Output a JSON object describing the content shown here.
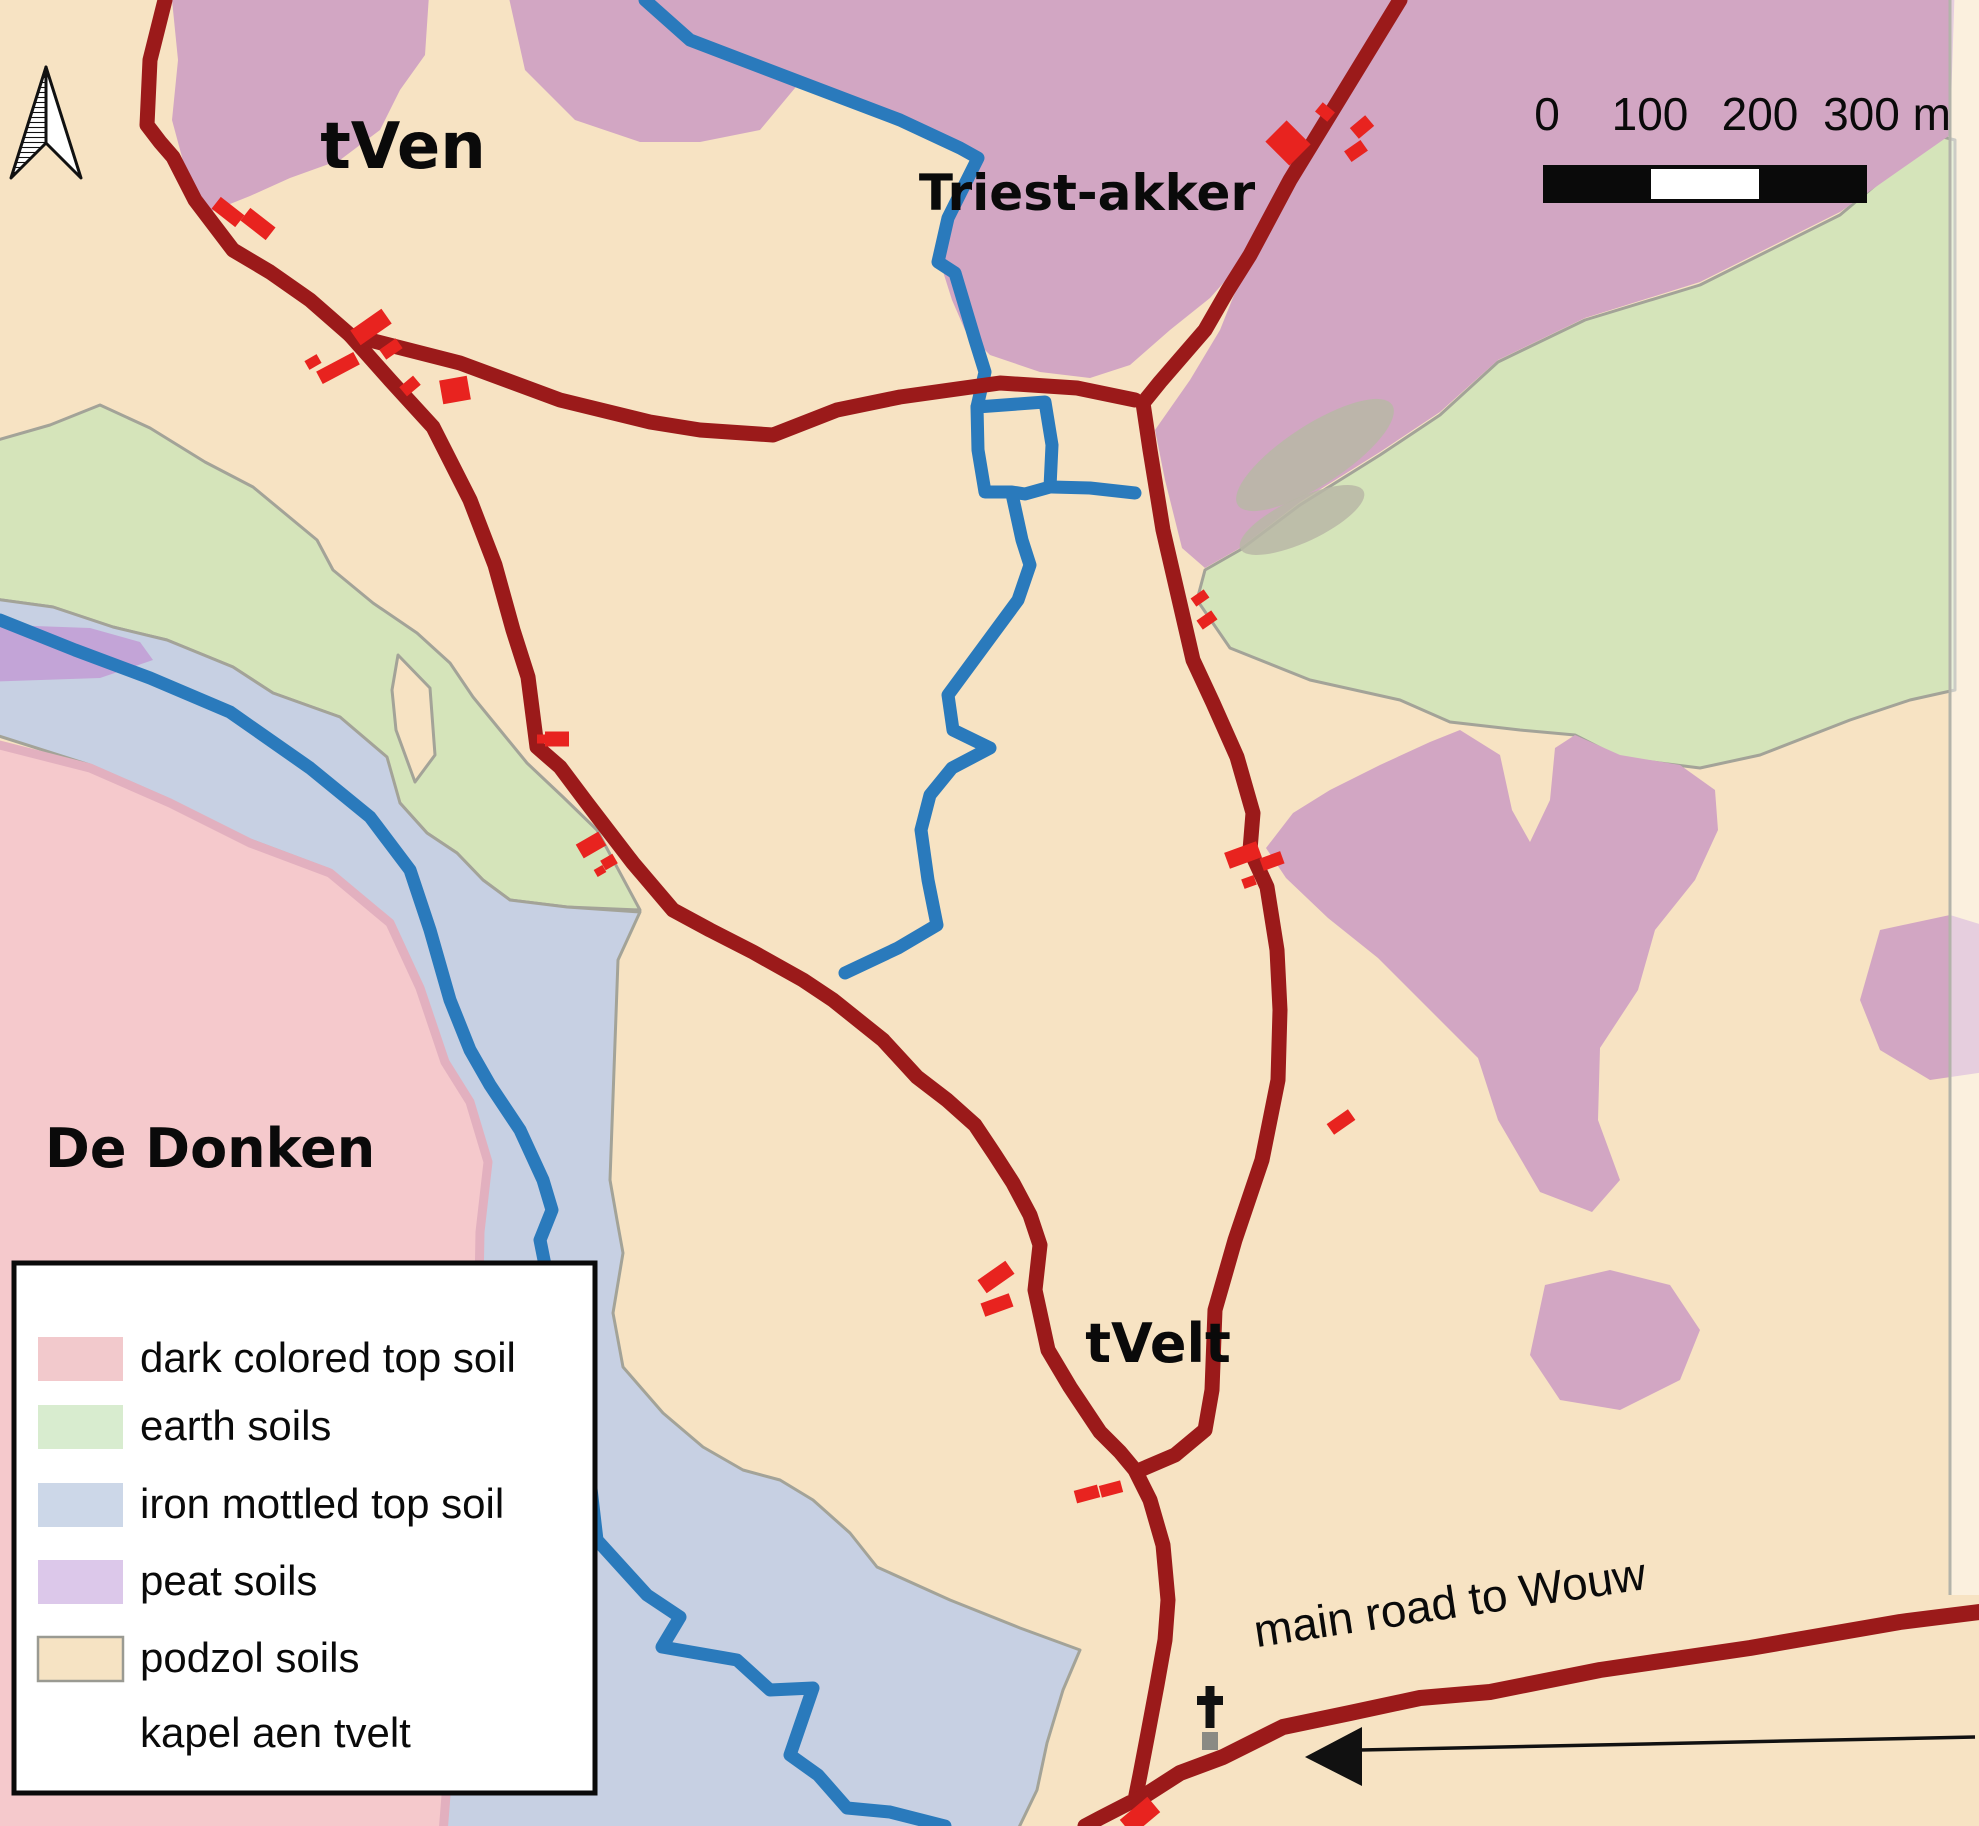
{
  "labels": {
    "tven": "tVen",
    "triest_akker": "Triest-akker",
    "de_donken": "De Donken",
    "tvelt": "tVelt",
    "main_road": "main road to Wouw"
  },
  "scalebar": {
    "ticks": [
      "0",
      "100",
      "200",
      "300 m"
    ]
  },
  "legend": {
    "items": [
      {
        "label": "dark colored top soil",
        "color": "#f2c9cc",
        "stroke": "none"
      },
      {
        "label": "earth soils",
        "color": "#d8eccf",
        "stroke": "none"
      },
      {
        "label": "iron mottled top soil",
        "color": "#ccd7e8",
        "stroke": "none"
      },
      {
        "label": "peat soils",
        "color": "#dcc8ea",
        "stroke": "none"
      },
      {
        "label": "podzol soils",
        "color": "#f6e3c3",
        "stroke": "#9a9a92"
      },
      {
        "label": "kapel aen tvelt"
      }
    ]
  },
  "colors": {
    "podzol": "#f7e3c3",
    "peat": "#d2a6c3",
    "lavender": "#c3a4d7",
    "earth": "#d5e4ba",
    "iron": "#c7d0e3",
    "darksoil": "#f5c9cc",
    "darksoil_border": "#e2b0bf",
    "gray": "#a3a398",
    "road": "#9b1a1a",
    "stream": "#2a7abc",
    "building": "#e8231f",
    "leaf": "#b9b7a6",
    "symbol_black": "#111111",
    "symbol_gray": "#8a8a84"
  },
  "map": {
    "regions": [
      {
        "name": "earth-soil-left",
        "fill": "earth",
        "stroke": "gray",
        "sw": 3,
        "pts": "-20,445 50,425 100,405 150,428 205,462 253,487 317,540 333,570 373,603 417,633 450,663 473,697 500,730 527,763 563,797 597,830 640,910 567,907 510,900 483,880 457,853 427,833 400,803 380,777 340,717 273,693 233,667 167,640 113,627 53,607 -20,597"
      },
      {
        "name": "iron-mottled-main",
        "fill": "iron",
        "stroke": "gray",
        "sw": 3,
        "pts": "-20,597 53,607 113,627 167,640 233,667 273,693 340,717 387,757 400,803 427,833 457,853 483,880 510,900 567,907 640,912 618,960 610,1180 617,1220 623,1253 613,1313 623,1367 663,1413 703,1447 743,1470 780,1480 813,1500 850,1533 877,1567 950,1600 1020,1628 1080,1650 1063,1690 1047,1743 1037,1790 1010,1846 445,1846 448,1750 460,1700 470,1600 477,1400 477,1250 488,1160 470,1100 445,1060 420,985 390,920 330,870 250,840 170,800 90,765 -20,730"
      },
      {
        "name": "dark-topsoil-dedonken",
        "fill": "darksoil",
        "stroke": "darksoil_border",
        "sw": 9,
        "pts": "-20,740 90,768 170,803 250,843 330,873 390,923 420,988 445,1062 470,1102 488,1162 480,1232 477,1400 460,1700 448,1770 442,1846 -20,1846"
      },
      {
        "name": "podzol-wedge",
        "fill": "podzol",
        "stroke": "gray",
        "sw": 3,
        "pts": "398,655 430,688 435,755 415,782 396,730 392,690"
      },
      {
        "name": "earth-soil-right",
        "fill": "earth",
        "stroke": "gray",
        "sw": 3,
        "pts": "1935,135 1840,215 1700,285 1585,320 1498,362 1440,415 1380,455 1300,505 1240,550 1205,570 1197,600 1230,648 1310,680 1400,700 1450,722 1520,730 1575,735 1620,758 1700,768 1760,755 1850,720 1910,700 1955,690 1955,140"
      },
      {
        "name": "peat-tven",
        "fill": "peat",
        "pts": "170,-20 430,-20 425,55 400,90 380,130 340,160 290,178 250,196 210,212 186,172 172,120 178,60"
      },
      {
        "name": "peat-triest-west",
        "fill": "peat",
        "pts": "505,-20 1402,-20 1345,90 1290,180 1242,262 1210,298 1170,330 1130,365 1090,378 1040,372 990,355 965,330 952,300 940,262 948,218 978,158 960,148 900,120 800,82 760,130 700,142 640,142 575,120 525,70"
      },
      {
        "name": "peat-triest-east",
        "fill": "peat",
        "pts": "1412,-20 1955,-20 1950,135 1840,212 1700,282 1585,318 1498,360 1440,412 1380,452 1300,502 1240,548 1205,568 1182,548 1165,480 1155,430 1190,380 1220,330 1242,275 1290,185 1345,92"
      },
      {
        "name": "peat-center-east",
        "fill": "peat",
        "pts": "1293,813 1330,790 1380,765 1430,742 1460,730 1500,755 1512,810 1530,842 1550,800 1555,748 1575,735 1620,755 1680,765 1715,790 1718,830 1695,880 1655,930 1638,990 1600,1048 1598,1120 1620,1180 1592,1212 1540,1192 1498,1120 1478,1058 1428,1008 1378,958 1328,918 1286,878 1266,848"
      },
      {
        "name": "peat-right-edge",
        "fill": "peat",
        "pts": "1880,930 1950,915 1999,930 1999,1070 1930,1080 1880,1050 1860,1000"
      },
      {
        "name": "peat-bottom-right",
        "fill": "peat",
        "pts": "1545,1285 1610,1270 1670,1285 1700,1330 1680,1380 1620,1410 1560,1400 1530,1355"
      },
      {
        "name": "peat-left-lavender",
        "fill": "lavender",
        "pts": "-20,624 90,628 140,642 153,660 100,678 -20,682"
      }
    ],
    "ellipses": [
      {
        "name": "gray-scrub-patch",
        "cx": 1315,
        "cy": 455,
        "rx": 92,
        "ry": 30,
        "rot": -33,
        "fill": "leaf",
        "op": 0.85
      },
      {
        "name": "gray-scrub-patch",
        "cx": 1302,
        "cy": 520,
        "rx": 68,
        "ry": 22,
        "rot": -25,
        "fill": "leaf",
        "op": 0.85
      }
    ],
    "streams": [
      {
        "pts": "645,0 690,40 800,82 900,120 960,148 978,158 948,218 938,262 955,273 975,340 985,372 977,407"
      },
      {
        "pts": "977,407 1045,402 1052,445 1050,487 1025,494 1012,492 985,492 978,450",
        "closed": true
      },
      {
        "pts": "1012,494 1022,540 1030,565 1018,600 948,695 953,730 990,748 952,768 930,795 921,830 928,880 937,925 898,948 845,973"
      },
      {
        "pts": "1052,487 1090,488 1135,493"
      },
      {
        "pts": "0,620 75,650 150,678 230,712 310,768 370,817 410,870 430,930 450,1000 470,1050 490,1085 520,1130 543,1180 552,1210 540,1240 548,1280 560,1350 575,1420 590,1480 597,1540 647,1595 680,1617 662,1647 737,1660 770,1690 813,1688 790,1755 818,1775 847,1808 890,1812 945,1826"
      }
    ],
    "roads": [
      {
        "w": 15,
        "pts": "165,0 150,60 147,125 160,142 173,157 195,200 233,250 270,272 310,300 350,335 390,380 433,427 470,500 495,565 513,630 528,677 537,747 560,767 587,803 633,863 673,910 710,930 753,952 803,980 833,1000 883,1040 917,1077 947,1100 975,1125 995,1155 1013,1183 1030,1215 1040,1245 1035,1290 1048,1350 1070,1387 1100,1432 1120,1452 1135,1470 1150,1500 1163,1545 1168,1600 1165,1640 1157,1685 1148,1733 1140,1775 1135,1800 1100,1818 1085,1826"
      },
      {
        "w": 15,
        "pts": "350,335 460,363 560,400 650,422 700,430 773,435 837,410 900,397 1000,383 1077,388 1135,400"
      },
      {
        "w": 15,
        "pts": "1400,0 1345,90 1290,180 1250,255 1228,290 1205,330 1160,382 1143,403 1150,450 1163,530 1193,660 1213,703 1237,757 1253,813 1250,850 1267,887 1277,950 1280,1010 1278,1080 1262,1160 1235,1240 1215,1310 1212,1390 1205,1430 1175,1455 1140,1470"
      },
      {
        "w": 16,
        "pts": "1138,1800 1180,1773 1223,1757 1283,1727 1350,1713 1420,1698 1490,1692 1600,1670 1750,1648 1900,1622 1979,1612"
      }
    ],
    "buildings": [
      {
        "x": 228,
        "y": 212,
        "w": 30,
        "h": 15,
        "r": 38
      },
      {
        "x": 258,
        "y": 224,
        "w": 32,
        "h": 16,
        "r": 38
      },
      {
        "x": 371,
        "y": 327,
        "w": 38,
        "h": 18,
        "r": -35
      },
      {
        "x": 391,
        "y": 349,
        "w": 20,
        "h": 12,
        "r": -35
      },
      {
        "x": 313,
        "y": 362,
        "w": 14,
        "h": 10,
        "r": -30
      },
      {
        "x": 338,
        "y": 368,
        "w": 42,
        "h": 14,
        "r": -28
      },
      {
        "x": 410,
        "y": 386,
        "w": 18,
        "h": 12,
        "r": -40
      },
      {
        "x": 455,
        "y": 390,
        "w": 28,
        "h": 24,
        "r": -10
      },
      {
        "x": 1288,
        "y": 143,
        "w": 34,
        "h": 30,
        "r": 45
      },
      {
        "x": 1325,
        "y": 112,
        "w": 16,
        "h": 12,
        "r": 40
      },
      {
        "x": 1362,
        "y": 127,
        "w": 20,
        "h": 14,
        "r": -40
      },
      {
        "x": 1356,
        "y": 151,
        "w": 20,
        "h": 13,
        "r": -35
      },
      {
        "x": 1200,
        "y": 598,
        "w": 16,
        "h": 10,
        "r": -35
      },
      {
        "x": 1207,
        "y": 620,
        "w": 18,
        "h": 11,
        "r": -35
      },
      {
        "x": 1243,
        "y": 855,
        "w": 34,
        "h": 17,
        "r": -20
      },
      {
        "x": 1272,
        "y": 861,
        "w": 22,
        "h": 13,
        "r": -20
      },
      {
        "x": 1249,
        "y": 882,
        "w": 13,
        "h": 10,
        "r": -20
      },
      {
        "x": 1341,
        "y": 1122,
        "w": 26,
        "h": 13,
        "r": -35
      },
      {
        "x": 996,
        "y": 1277,
        "w": 34,
        "h": 16,
        "r": -35
      },
      {
        "x": 997,
        "y": 1305,
        "w": 30,
        "h": 14,
        "r": -20
      },
      {
        "x": 1087,
        "y": 1494,
        "w": 24,
        "h": 13,
        "r": -15
      },
      {
        "x": 1111,
        "y": 1489,
        "w": 22,
        "h": 12,
        "r": -15
      },
      {
        "x": 557,
        "y": 739,
        "w": 24,
        "h": 15,
        "r": 0
      },
      {
        "x": 543,
        "y": 739,
        "w": 12,
        "h": 9,
        "r": 0
      },
      {
        "x": 591,
        "y": 845,
        "w": 26,
        "h": 16,
        "r": -30
      },
      {
        "x": 609,
        "y": 862,
        "w": 14,
        "h": 11,
        "r": -30
      },
      {
        "x": 600,
        "y": 871,
        "w": 10,
        "h": 8,
        "r": -30
      },
      {
        "x": 1140,
        "y": 1816,
        "w": 36,
        "h": 20,
        "r": -40
      }
    ],
    "kapel_symbols": [
      {
        "x": 1210,
        "y": 1712,
        "s": 1.0
      },
      {
        "x": 78,
        "y": 1732,
        "s": 1.15
      }
    ],
    "direction_arrow": {
      "line": [
        1360,
        1750,
        1975,
        1737
      ],
      "head": "1305,1757 1362,1727 1362,1786"
    },
    "edge_strip": {
      "pts": "1950,-20 1999,-20 1999,1595 1950,1595",
      "line": [
        1950,
        -20,
        1950,
        1595
      ]
    }
  }
}
